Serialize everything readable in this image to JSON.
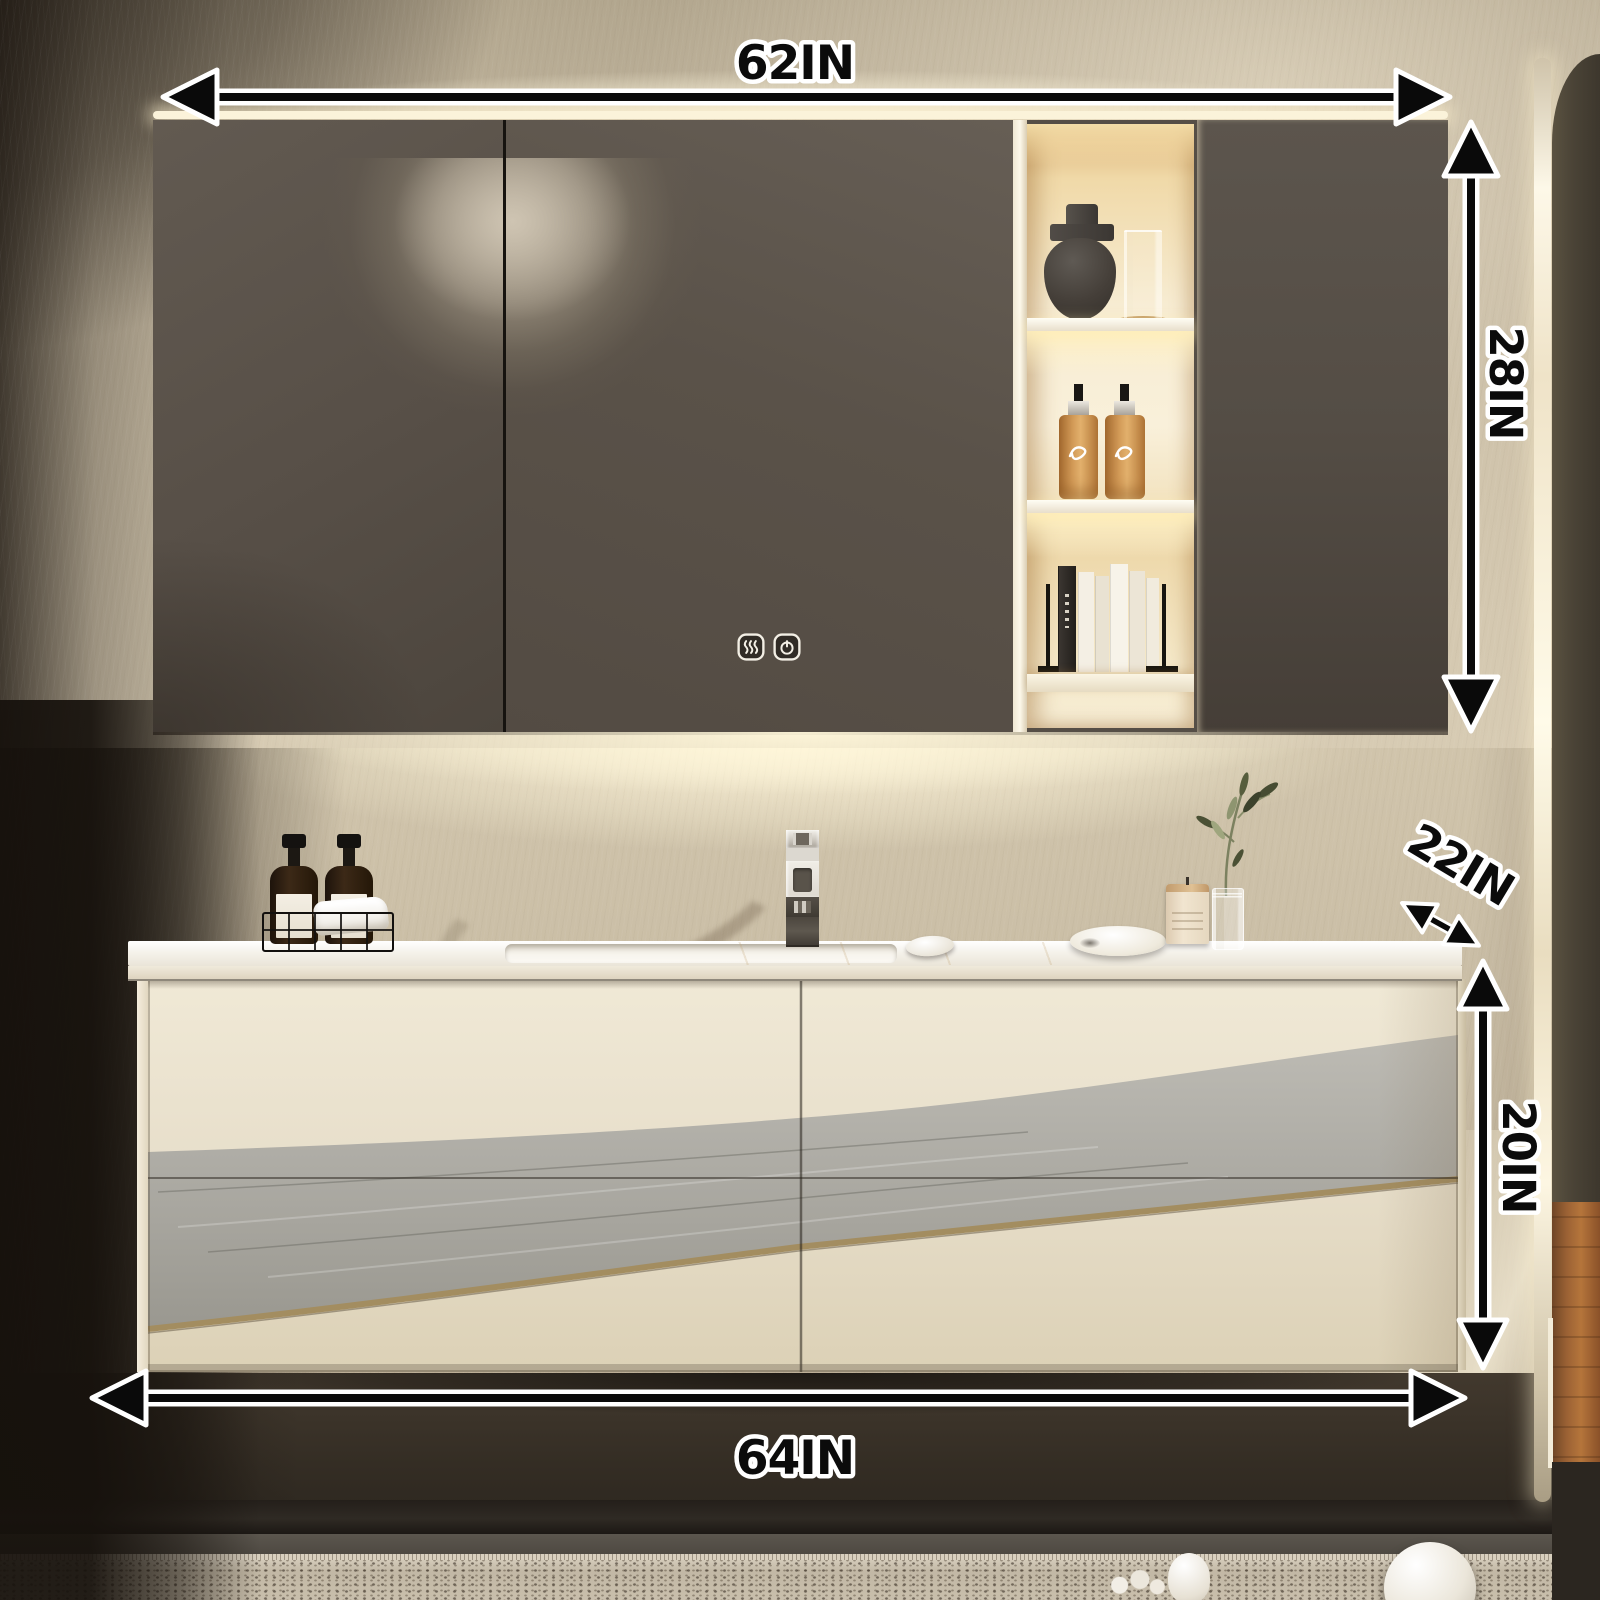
{
  "image": {
    "type": "product-photo",
    "subject": "Wall-mounted floating bathroom vanity with backlit storage mirror cabinet"
  },
  "annotations": {
    "top_width": "62IN",
    "cabinet_height": "28IN",
    "counter_depth": "22IN",
    "vanity_height": "20IN",
    "bottom_width": "64IN"
  },
  "mirror_cabinet": {
    "touch_controls": [
      {
        "icon": "defogger-icon"
      },
      {
        "icon": "power-icon"
      }
    ],
    "shelf_items": [
      "dark ceramic sculptural vase",
      "glass tumbler on wood coaster",
      "two amber pump bottles",
      "books between black metal bookends"
    ]
  },
  "countertop_items": [
    "two black soap dispensers in black wire caddy with white towel",
    "chrome column smart faucet",
    "white soap pebble",
    "long white dish",
    "cream candle jar",
    "glass bud vase with olive sprig"
  ],
  "colors": {
    "annotation_text": "#0b0b0b",
    "annotation_outline": "#ffffff",
    "cabinet_door": "#564f47",
    "niche_glow": "#f7ecd2",
    "vanity_body": "#e7ddc6",
    "vanity_wood_band": "#aaa8a1",
    "vanity_accent_curve": "#a38d60",
    "countertop": "#f6f3ec",
    "wall": "#c9bda5",
    "wood_floor": "#9a6134"
  }
}
